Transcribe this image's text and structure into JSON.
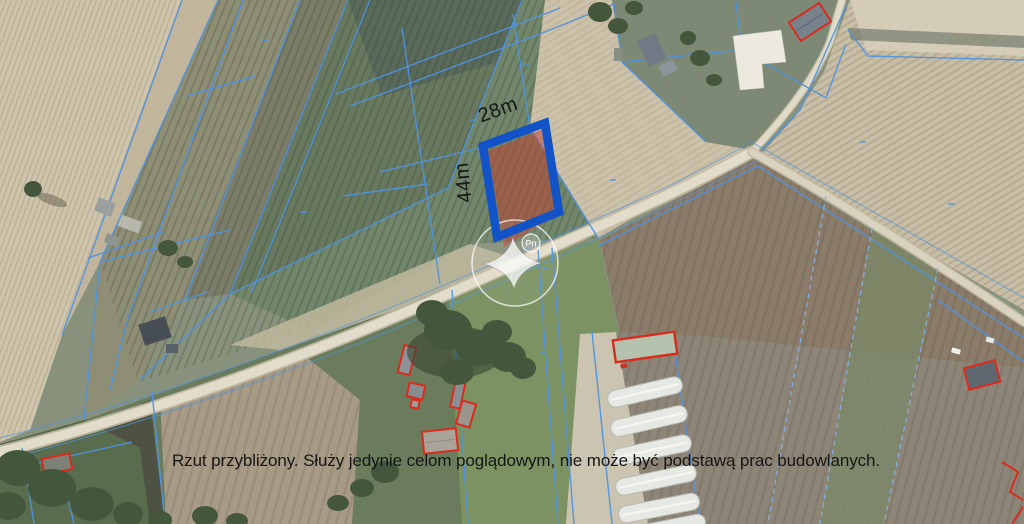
{
  "map": {
    "plot": {
      "width_label": "28m",
      "height_label": "44m"
    },
    "compass": {
      "north_label": "Pn"
    },
    "disclaimer": "Rzut przybliżony. Służy jedynie celom poglądowym, nie może być podstawą prac budowlanych.",
    "colors": {
      "highlight_border": "#1254c8",
      "highlight_fill": "#bf4030",
      "cadastral_line": "#4f92e2",
      "cadastral_line_light": "#85b2ea",
      "building_outline": "#d92c1f",
      "label_text": "#161616"
    }
  }
}
